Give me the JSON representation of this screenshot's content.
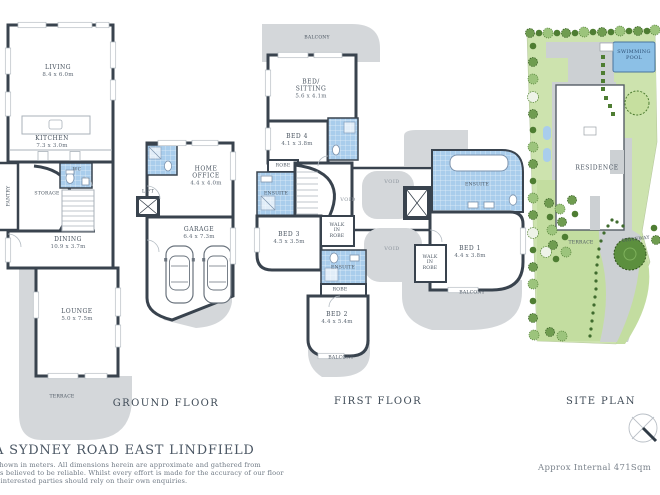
{
  "header": {
    "address": "A SYDNEY ROAD  EAST LINDFIELD"
  },
  "footer": {
    "disclaimer_lines": [
      "shown in meters. All dimensions herein are approximate and gathered from",
      "es believed to be reliable. Whilst every effort is made for the accuracy of our floor",
      ", interested parties should rely on their own enquiries."
    ],
    "approx_internal": "Approx Internal 471Sqm"
  },
  "ground_floor": {
    "title": "GROUND FLOOR",
    "rooms": {
      "living": {
        "name": "LIVING",
        "dims": "8.4 x 6.0m"
      },
      "kitchen": {
        "name": "KITCHEN",
        "dims": "7.3 x 3.0m"
      },
      "pantry": {
        "name": "PANTRY"
      },
      "wc": {
        "name": "WC"
      },
      "storage": {
        "name": "STORAGE"
      },
      "lift": {
        "name": "LIFT"
      },
      "dining": {
        "name": "DINING",
        "dims": "10.9 x 3.7m"
      },
      "lounge": {
        "name": "LOUNGE",
        "dims": "5.0 x 7.5m"
      },
      "terrace": {
        "name": "TERRACE"
      },
      "home_office": {
        "name": "HOME OFFICE",
        "dims": "4.4 x 4.0m"
      },
      "garage": {
        "name": "GARAGE",
        "dims": "6.4 x 7.3m"
      }
    }
  },
  "first_floor": {
    "title": "FIRST FLOOR",
    "rooms": {
      "balcony_top": {
        "name": "BALCONY"
      },
      "bed_sitting": {
        "name": "BED/ SITTING",
        "dims": "5.6 x 4.1m"
      },
      "bed4": {
        "name": "BED 4",
        "dims": "4.1 x 3.8m"
      },
      "robe1": {
        "name": "ROBE"
      },
      "ensuite3": {
        "name": "ENSUITE"
      },
      "bed3": {
        "name": "BED 3",
        "dims": "4.5 x 3.5m"
      },
      "walk_in_robe1": {
        "name": "WALK IN ROBE"
      },
      "void1": {
        "name": "VOID"
      },
      "void2": {
        "name": "VOID"
      },
      "void3": {
        "name": "VOID"
      },
      "ensuite2": {
        "name": "ENSUITE"
      },
      "robe2": {
        "name": "ROBE"
      },
      "bed2": {
        "name": "BED 2",
        "dims": "4.4 x 5.4m"
      },
      "balcony_bottom": {
        "name": "BALCONY"
      },
      "ensuite1": {
        "name": "ENSUITE"
      },
      "bed1": {
        "name": "BED 1",
        "dims": "4.4 x 3.8m"
      },
      "walk_in_robe2": {
        "name": "WALK IN ROBE"
      },
      "balcony_right": {
        "name": "BALCONY"
      }
    }
  },
  "site_plan": {
    "title": "SITE PLAN",
    "areas": {
      "swimming_pool": {
        "name": "SWIMMING POOL"
      },
      "residence": {
        "name": "RESIDENCE"
      },
      "terrace": {
        "name": "TERRACE"
      },
      "driveway": {
        "name": "DRIVEWAY"
      }
    }
  },
  "colors": {
    "wall": "#39434e",
    "paved": "#d4d7da",
    "wet_area": "#a9cdec",
    "lawn": "#cde3ae",
    "tree_dark": "#4e7d32",
    "pool": "#8cc0e6"
  }
}
